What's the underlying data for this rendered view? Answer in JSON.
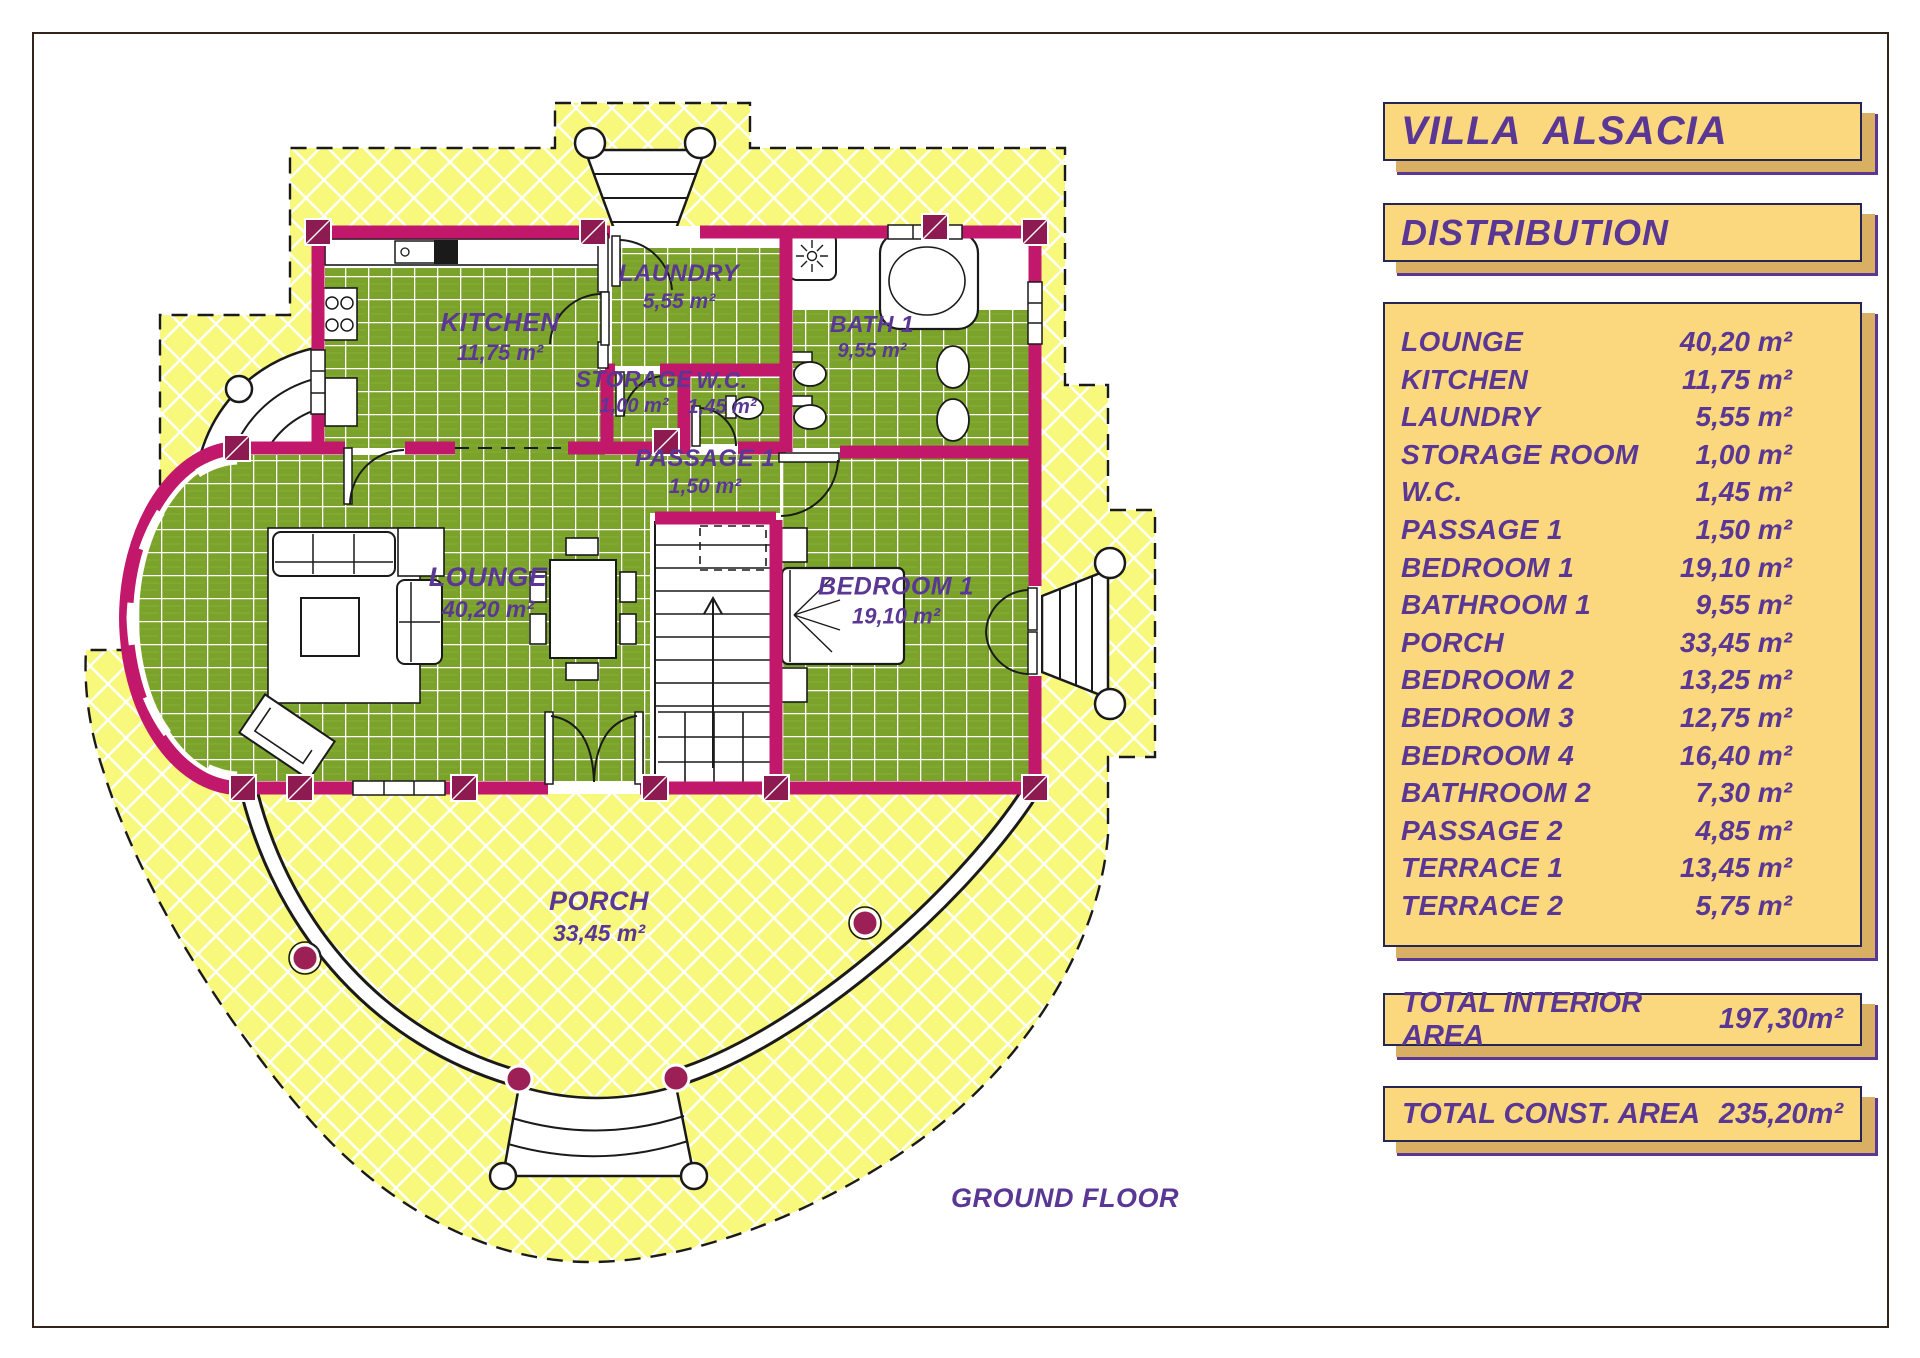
{
  "title": "VILLA  ALSACIA",
  "section_header": "DISTRIBUTION",
  "distribution": {
    "rows": [
      {
        "name": "LOUNGE",
        "area": "40,20 m²"
      },
      {
        "name": "KITCHEN",
        "area": "11,75 m²"
      },
      {
        "name": "LAUNDRY",
        "area": "5,55 m²"
      },
      {
        "name": "STORAGE ROOM",
        "area": "1,00 m²"
      },
      {
        "name": "W.C.",
        "area": "1,45 m²"
      },
      {
        "name": "PASSAGE 1",
        "area": "1,50 m²"
      },
      {
        "name": "BEDROOM 1",
        "area": "19,10 m²"
      },
      {
        "name": "BATHROOM 1",
        "area": "9,55 m²"
      },
      {
        "name": "PORCH",
        "area": "33,45 m²"
      },
      {
        "name": "BEDROOM 2",
        "area": "13,25 m²"
      },
      {
        "name": "BEDROOM 3",
        "area": "12,75 m²"
      },
      {
        "name": "BEDROOM 4",
        "area": "16,40 m²"
      },
      {
        "name": "BATHROOM 2",
        "area": "7,30 m²"
      },
      {
        "name": "PASSAGE 2",
        "area": "4,85 m²"
      },
      {
        "name": "TERRACE 1",
        "area": "13,45 m²"
      },
      {
        "name": "TERRACE 2",
        "area": "5,75 m²"
      }
    ]
  },
  "totals": {
    "interior": {
      "label": "TOTAL INTERIOR AREA",
      "value": "197,30m²"
    },
    "construction": {
      "label": "TOTAL CONST. AREA",
      "value": "235,20m²"
    }
  },
  "plan": {
    "caption": "GROUND FLOOR",
    "rooms": [
      {
        "name": "KITCHEN",
        "area": "11,75 m²"
      },
      {
        "name": "LAUNDRY",
        "area": "5,55 m²"
      },
      {
        "name": "BATH 1",
        "area": "9,55 m²"
      },
      {
        "name": "STORAGE",
        "area": "1,00 m²"
      },
      {
        "name": "W.C.",
        "area": "1,45 m²"
      },
      {
        "name": "PASSAGE 1",
        "area": "1,50 m²"
      },
      {
        "name": "LOUNGE",
        "area": "40,20 m²"
      },
      {
        "name": "BEDROOM 1",
        "area": "19,10 m²"
      },
      {
        "name": "PORCH",
        "area": "33,45 m²"
      }
    ]
  },
  "colors": {
    "panel_fill": "#FBD87E",
    "panel_shadow": "#D9AF63",
    "text_purple": "#5A3794",
    "wall_magenta": "#C2186B",
    "tile_green": "#7BA32B",
    "roof_yellow": "#F8F87D",
    "column_maroon": "#9C2056"
  }
}
